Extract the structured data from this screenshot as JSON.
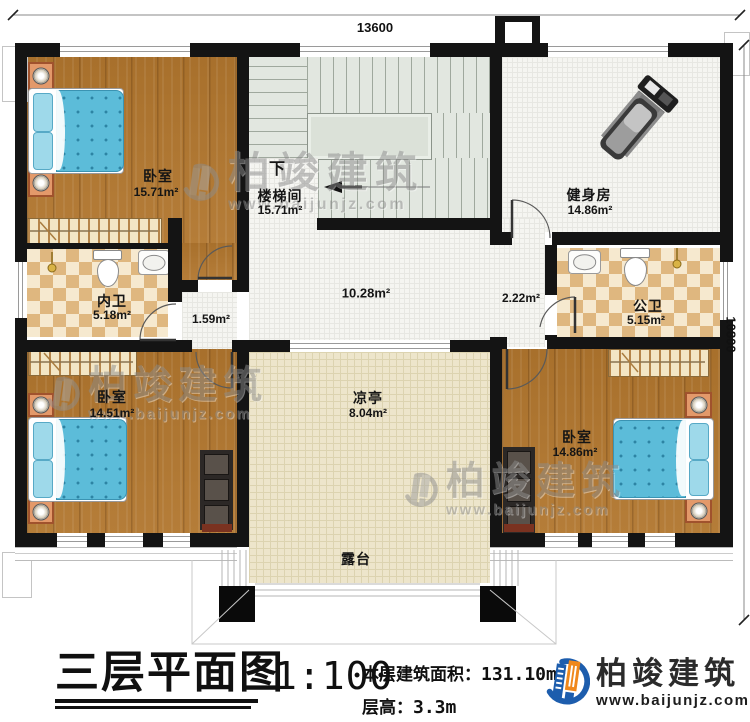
{
  "dimensions": {
    "width_mm": "13600",
    "height_mm": "10800"
  },
  "rooms": {
    "bedroom_tl": {
      "name": "卧室",
      "area": "15.71m²"
    },
    "stairwell": {
      "name": "楼梯间",
      "area": "15.71m²",
      "down_label": "下"
    },
    "gym": {
      "name": "健身房",
      "area": "14.86m²"
    },
    "bath_inner": {
      "name": "内卫",
      "area": "5.18m²"
    },
    "bath_public": {
      "name": "公卫",
      "area": "5.15m²"
    },
    "hall": {
      "area": "10.28m²"
    },
    "vestibule": {
      "area": "1.59m²"
    },
    "corridor": {
      "area": "2.22m²"
    },
    "bedroom_bl": {
      "name": "卧室",
      "area": "14.51m²"
    },
    "bedroom_br": {
      "name": "卧室",
      "area": "14.86m²"
    },
    "pavilion": {
      "name": "凉亭",
      "area": "8.04m²"
    },
    "terrace": {
      "name": "露台"
    }
  },
  "title_block": {
    "title": "三层平面图",
    "scale": "1:100",
    "area_label": "本层建筑面积：",
    "area_value": "131.10m²",
    "floor_height_label": "层高：",
    "floor_height_value": "3.3m"
  },
  "brand": {
    "name": "柏竣建筑",
    "website": "www.baijunjz.com"
  },
  "colors": {
    "wall": "#141414",
    "wood_floor": "#b1762e",
    "tile_dark": "#dfb77f",
    "tile_light": "#f6e9cf",
    "stair_floor": "#e2e7e0",
    "pavilion_floor": "#ede5cb",
    "bed_blanket": "#5cbcd9",
    "logo_blue": "#1d5dad",
    "logo_orange": "#f0881c"
  }
}
